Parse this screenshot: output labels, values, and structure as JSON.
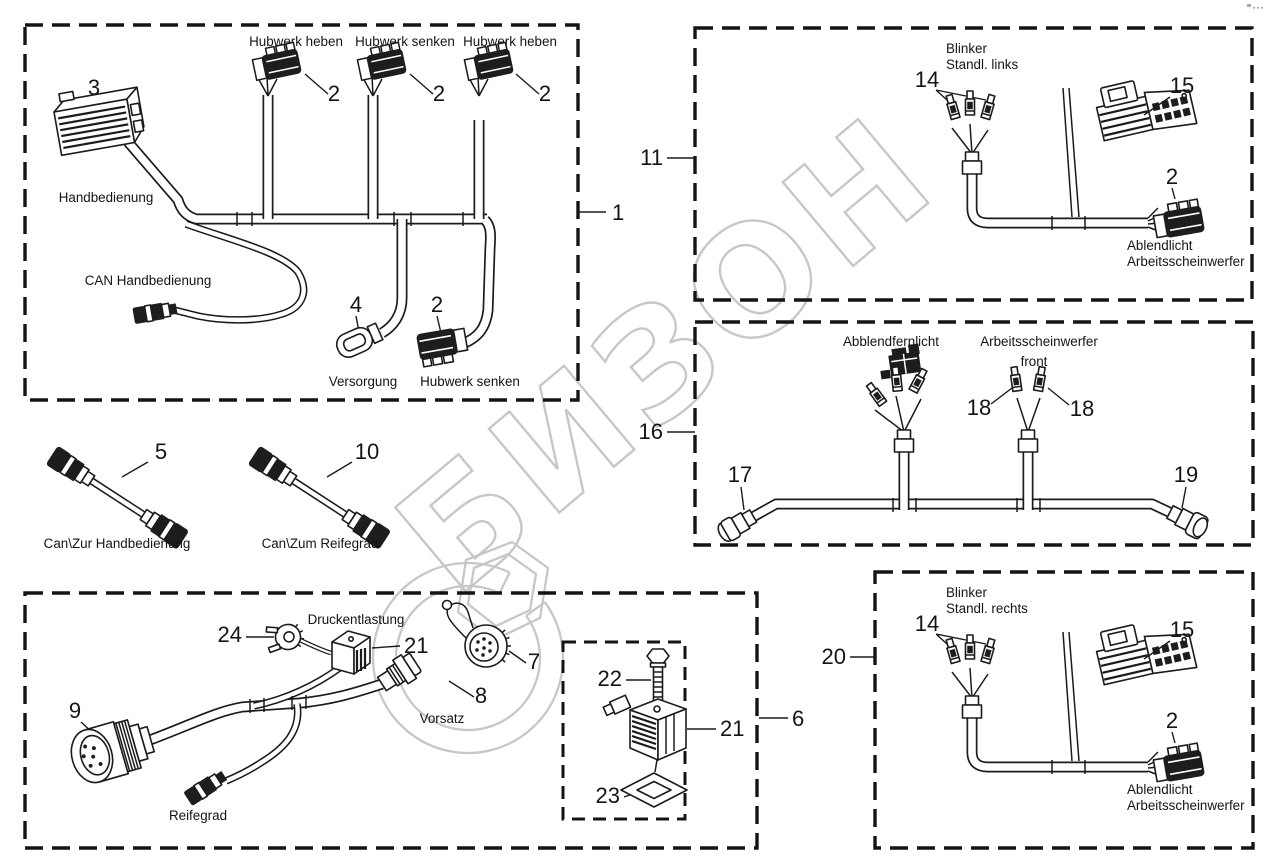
{
  "watermark": {
    "text": "БИЗОН",
    "color": "#c7c7c7"
  },
  "harness_1": {
    "ref": "1",
    "connectors": {
      "top1": {
        "label": "Hubwerk heben",
        "ref": "2"
      },
      "top2": {
        "label": "Hubwerk senken",
        "ref": "2"
      },
      "top3": {
        "label": "Hubwerk heben",
        "ref": "2"
      },
      "block": {
        "ref": "3",
        "label": "Handbedienung"
      },
      "can": {
        "label": "CAN Handbedienung"
      },
      "supply": {
        "ref": "4",
        "label": "Versorgung"
      },
      "lower": {
        "ref": "2",
        "label": "Hubwerk senken"
      }
    }
  },
  "cable_5": {
    "ref": "5",
    "label": "Can\\Zur Handbedienung"
  },
  "cable_10": {
    "ref": "10",
    "label": "Can\\Zum Reifegrad"
  },
  "harness_11": {
    "ref": "11",
    "terminal_label_line1": "Blinker",
    "terminal_label_line2": "Standl. links",
    "ref_terminals": "14",
    "ref_connector": "15",
    "ref_plug": "2",
    "plug_label_line1": "Ablendlicht",
    "plug_label_line2": "Arbeitsscheinwerfer"
  },
  "harness_16": {
    "ref": "16",
    "left_branch_label": "Abblendfernlicht",
    "right_branch_label_line1": "Arbeitsscheinwerfer",
    "right_branch_label_line2": "front",
    "ref_left_connector": "17",
    "ref_terminal_left": "18",
    "ref_terminal_right": "18",
    "ref_right_connector": "19"
  },
  "harness_20": {
    "ref": "20",
    "terminal_label_line1": "Blinker",
    "terminal_label_line2": "Standl. rechts",
    "ref_terminals": "14",
    "ref_connector": "15",
    "ref_plug": "2",
    "plug_label_line1": "Ablendlicht",
    "plug_label_line2": "Arbeitsscheinwerfer"
  },
  "harness_6": {
    "ref": "6",
    "ref_plug": "24",
    "valve_label": "Druckentlastung",
    "ref_valve": "21",
    "ref_cap": "7",
    "ref_socket": "8",
    "socket_label": "Vorsatz",
    "ref_main_connector": "9",
    "tire_label": "Reifegrad",
    "valve_assembly": {
      "ref": "21",
      "ref_bolt": "22",
      "ref_seal": "23"
    }
  }
}
